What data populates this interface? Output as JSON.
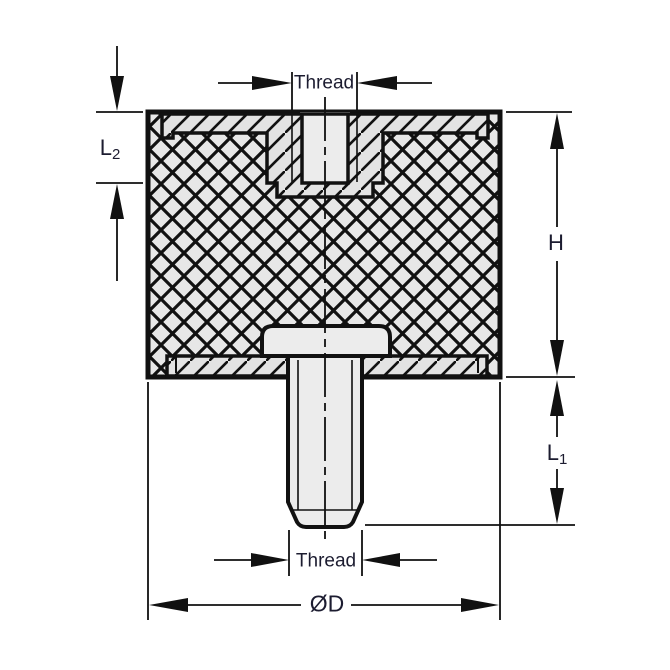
{
  "diagram": {
    "kind": "technical-cross-section",
    "labels": {
      "thread_top": "Thread",
      "thread_bottom": "Thread",
      "height": "H",
      "l1": {
        "base": "L",
        "sub": "1"
      },
      "l2": {
        "base": "L",
        "sub": "2"
      },
      "diameter": "ØD"
    },
    "colors": {
      "line": "#111111",
      "label_text": "#1c1c30",
      "rubber_fill": "#e7e7e7",
      "metal_fill": "#e3e3e3",
      "plain_fill": "#ececec",
      "background": "#ffffff"
    }
  }
}
